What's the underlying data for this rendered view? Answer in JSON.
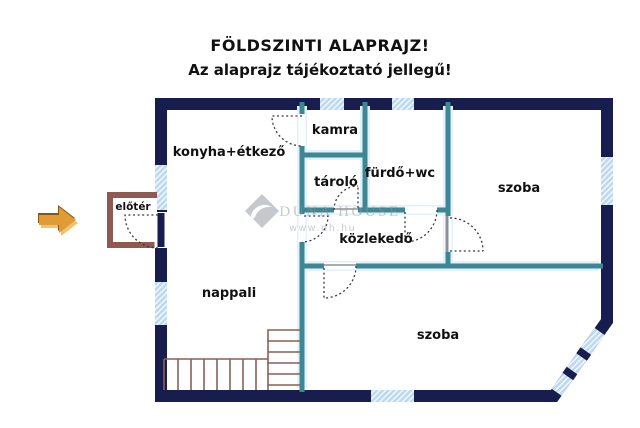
{
  "title": "FÖLDSZINTI ALAPRAJZ!",
  "subtitle": "Az alaprajz tájékoztató jellegű!",
  "rooms": {
    "konyha_etkezo": "konyha+étkező",
    "kamra": "kamra",
    "tarolo": "tároló",
    "furdo_wc": "fürdő+wc",
    "szoba_felso": "szoba",
    "kozlekedo": "közlekedő",
    "nappali": "nappali",
    "szoba_also": "szoba",
    "eloter": "előtér"
  },
  "watermark": {
    "brand": "Duna House",
    "brand_display": "DUNA HOUSE",
    "url": "www.dh.hu"
  },
  "colors": {
    "outer_wall": "#171e4e",
    "inner_wall": "#3d8795",
    "wall_halo": "#e2f1fa",
    "window": "#bcd9ef",
    "annex_wall": "#8f5a50",
    "stairs": "#8b5f57",
    "arrow": "#e09b35",
    "arrow_dark": "#8a5512",
    "arrow_light": "#f0c170",
    "watermark": "#8d949e",
    "door_threshold": "#8a9096"
  }
}
